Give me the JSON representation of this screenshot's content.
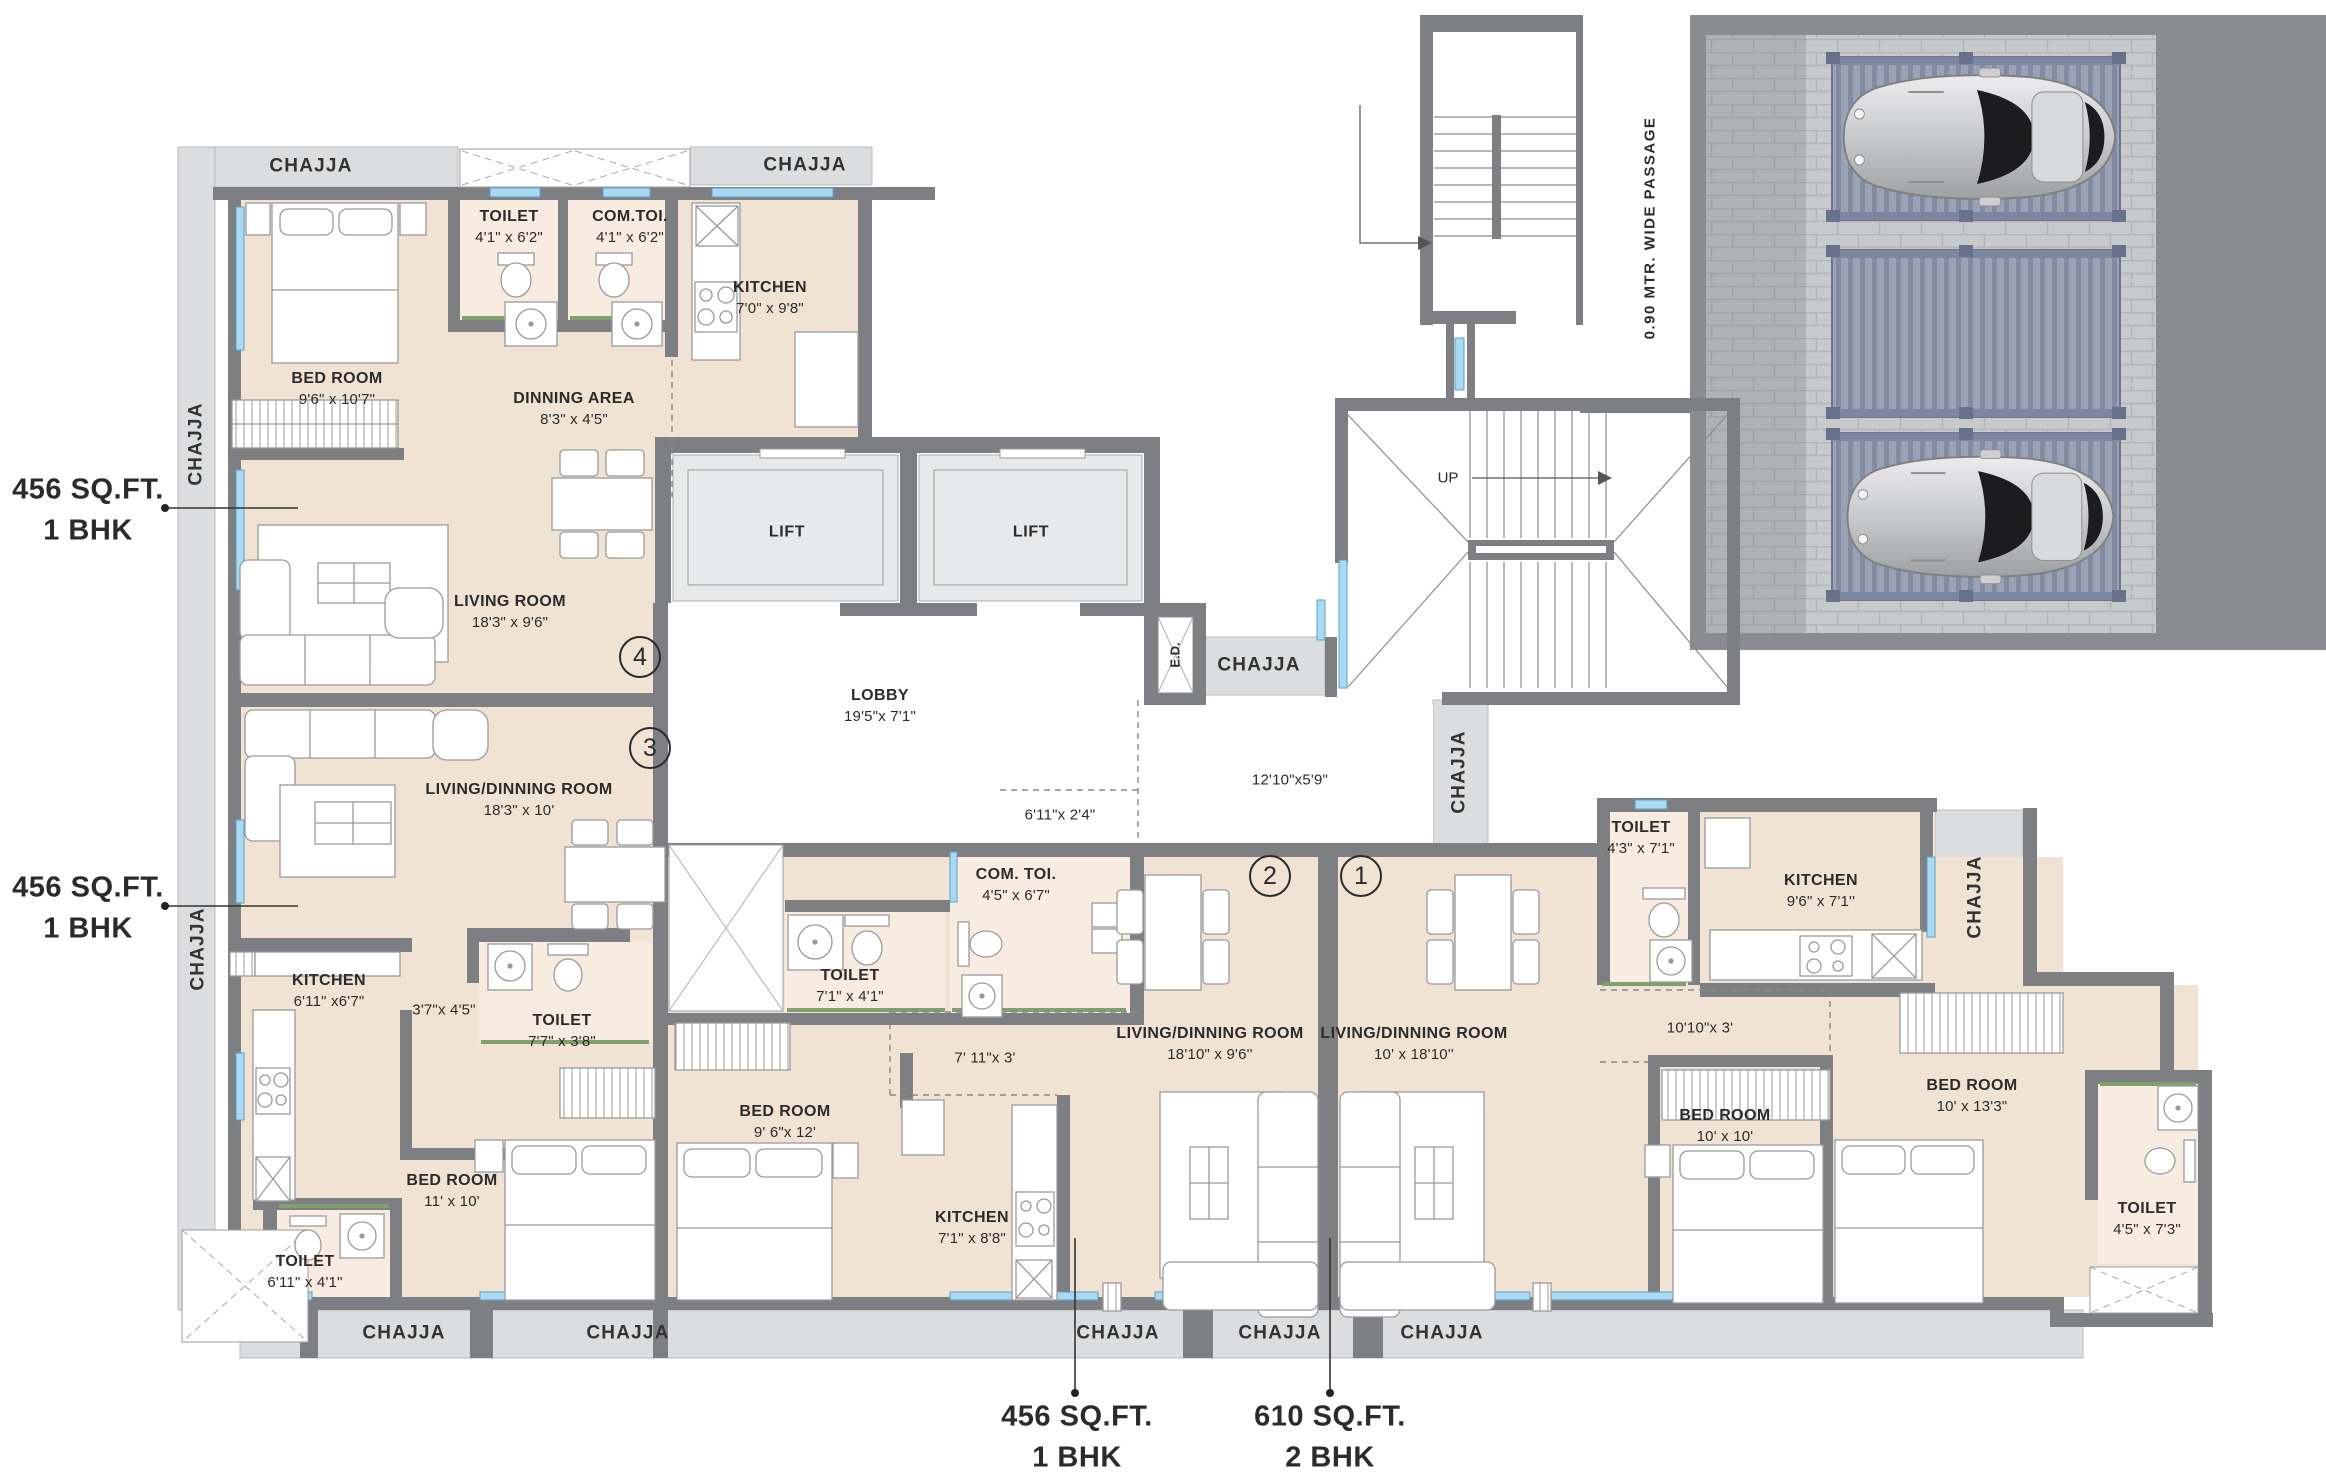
{
  "common": {
    "chajja": "CHAJJA",
    "lift": "LIFT",
    "ed": "E.D.",
    "up": "UP",
    "lobby_name": "LOBBY",
    "lobby_dim": "19'5\"x 7'1\"",
    "mid_dim": "12'10\"x5'9\"",
    "small_dim": "6'11\"x 2'4\"",
    "passage": "0.90 MTR. WIDE PASSAGE"
  },
  "units": {
    "u4": {
      "num": "4",
      "area_line1": "456 SQ.FT.",
      "area_line2": "1 BHK",
      "bed_name": "BED ROOM",
      "bed_dim": "9'6\" x 10'7\"",
      "toilet_name": "TOILET",
      "toilet_dim": "4'1\" x 6'2\"",
      "comtoi_name": "COM.TOI.",
      "comtoi_dim": "4'1\" x 6'2\"",
      "kitchen_name": "KITCHEN",
      "kitchen_dim": "7'0\" x 9'8\"",
      "dining_name": "DINNING AREA",
      "dining_dim": "8'3\" x 4'5\"",
      "living_name": "LIVING ROOM",
      "living_dim": "18'3\" x 9'6\""
    },
    "u3": {
      "num": "3",
      "area_line1": "456 SQ.FT.",
      "area_line2": "1 BHK",
      "living_name": "LIVING/DINNING ROOM",
      "living_dim": "18'3\" x 10'",
      "kitchen_name": "KITCHEN",
      "kitchen_dim": "6'11\" x6'7\"",
      "pass_dim": "3'7\"x 4'5\"",
      "toilet1_name": "TOILET",
      "toilet1_dim": "7'7\" x 3'8\"",
      "bed_name": "BED ROOM",
      "bed_dim": "11' x 10'",
      "toilet2_name": "TOILET",
      "toilet2_dim": "6'11\" x 4'1\""
    },
    "u2": {
      "num": "2",
      "area_line1": "456 SQ.FT.",
      "area_line2": "1 BHK",
      "toilet_name": "TOILET",
      "toilet_dim": "7'1\" x 4'1\"",
      "comtoi_name": "COM. TOI.",
      "comtoi_dim": "4'5\" x 6'7\"",
      "bed_name": "BED ROOM",
      "bed_dim": "9' 6\"x 12'",
      "pass_dim": "7' 11\"x 3'",
      "kitchen_name": "KITCHEN",
      "kitchen_dim": "7'1\" x 8'8\"",
      "living_name": "LIVING/DINNING ROOM",
      "living_dim": "18'10\" x 9'6''"
    },
    "u1": {
      "num": "1",
      "area_line1": "610 SQ.FT.",
      "area_line2": "2 BHK",
      "living_name": "LIVING/DINNING ROOM",
      "living_dim": "10' x 18'10''",
      "toilet1_name": "TOILET",
      "toilet1_dim": "4'3\" x 7'1\"",
      "kitchen_name": "KITCHEN",
      "kitchen_dim": "9'6\" x 7'1''",
      "pass_dim": "10'10\"x 3'",
      "bed1_name": "BED ROOM",
      "bed1_dim": "10' x 10'",
      "bed2_name": "BED ROOM",
      "bed2_dim": "10' x 13'3\"",
      "toilet2_name": "TOILET",
      "toilet2_dim": "4'5\" x 7'3\""
    }
  }
}
